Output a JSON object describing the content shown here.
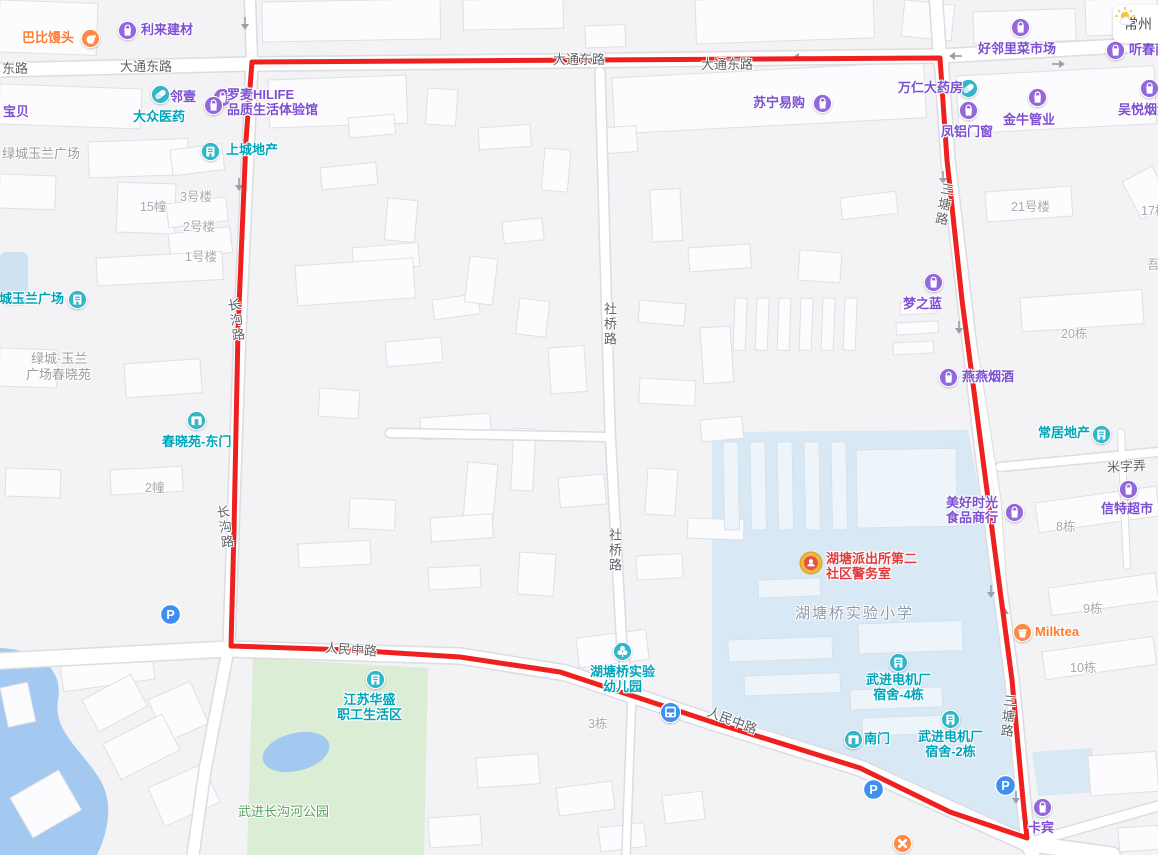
{
  "weather": {
    "city": "常州",
    "icon": "sun-cloud-icon"
  },
  "colors": {
    "purple": {
      "icon": "#9468dd",
      "text": "#7d4fd2"
    },
    "teal": {
      "icon": "#31b6ca",
      "text": "#00a4ba"
    },
    "orange": {
      "icon": "#ff8a45",
      "text": "#ff7a2e"
    },
    "red": {
      "icon": "#efb83d",
      "text": "#e03c3c"
    },
    "blue": {
      "icon": "#3d8ff2",
      "text": "#3d8ff2"
    },
    "boundary": "#ee2020",
    "water": "#a3c9f1",
    "park": "#dcedd6",
    "school_zone": "#d8e8f4"
  },
  "pois": [
    {
      "name": "babi-mantou",
      "text": "巴比馒头",
      "color": "orange",
      "icon": "hand",
      "ix": 90,
      "iy": 38,
      "tx": 22,
      "ty": 30
    },
    {
      "name": "lilai-jiancai",
      "text": "利来建材",
      "color": "purple",
      "icon": "bag",
      "ix": 127,
      "iy": 30,
      "tx": 141,
      "ty": 22
    },
    {
      "name": "haolinli-market",
      "text": "好邻里菜市场",
      "color": "purple",
      "icon": "bag",
      "ix": 1020,
      "iy": 27,
      "tx": 978,
      "ty": 41
    },
    {
      "name": "tingchun",
      "text": "听春南",
      "color": "purple",
      "icon": "bag",
      "ix": 1115,
      "iy": 50,
      "tx": 1129,
      "ty": 42
    },
    {
      "name": "linlinyi",
      "text": "邻邻壹",
      "color": "purple",
      "icon": "bag",
      "ix": 222,
      "iy": 97,
      "tx": 157,
      "ty": 89
    },
    {
      "name": "baobei",
      "text": "宝贝",
      "color": "purple",
      "tx": 3,
      "ty": 104
    },
    {
      "name": "dazhong-pharmacy",
      "text": "大众医药",
      "color": "teal",
      "icon": "pill",
      "ix": 160,
      "iy": 94,
      "tx": 133,
      "ty": 109
    },
    {
      "name": "luomai-hilife",
      "text": "罗麦HILIFE",
      "text2": "品质生活体验馆",
      "color": "purple",
      "icon": "bag",
      "ix": 213,
      "iy": 105,
      "tx": 227,
      "ty": 87
    },
    {
      "name": "shangcheng-estate",
      "text": "上城地产",
      "color": "teal",
      "icon": "estate",
      "ix": 210,
      "iy": 151,
      "tx": 226,
      "ty": 142
    },
    {
      "name": "suning",
      "text": "苏宁易购",
      "color": "purple",
      "icon": "bag",
      "ix": 822,
      "iy": 103,
      "tx": 753,
      "ty": 95
    },
    {
      "name": "wanren-pharmacy",
      "text": "万仁大药房",
      "color": "purple",
      "icon": "pill",
      "iconColor": "teal",
      "ix": 968,
      "iy": 88,
      "tx": 898,
      "ty": 80
    },
    {
      "name": "fenglv-doors",
      "text": "凤铝门窗",
      "color": "purple",
      "icon": "bag",
      "ix": 968,
      "iy": 110,
      "tx": 941,
      "ty": 124
    },
    {
      "name": "jinniu-pipes",
      "text": "金牛管业",
      "color": "purple",
      "icon": "bag",
      "ix": 1037,
      "iy": 97,
      "tx": 1003,
      "ty": 112
    },
    {
      "name": "wuyue-tobacco",
      "text": "吴悦烟酒",
      "color": "purple",
      "icon": "bag",
      "ix": 1149,
      "iy": 88,
      "tx": 1118,
      "ty": 102
    },
    {
      "name": "mengzhilan",
      "text": "梦之蓝",
      "color": "purple",
      "icon": "bag",
      "ix": 933,
      "iy": 282,
      "tx": 903,
      "ty": 296
    },
    {
      "name": "yanyan-tobacco",
      "text": "燕燕烟酒",
      "color": "purple",
      "icon": "bag",
      "ix": 948,
      "iy": 377,
      "tx": 962,
      "ty": 369
    },
    {
      "name": "changju-estate",
      "text": "常居地产",
      "color": "teal",
      "icon": "estate",
      "ix": 1101,
      "iy": 434,
      "tx": 1038,
      "ty": 425
    },
    {
      "name": "xinte-supermarket",
      "text": "信特超市",
      "color": "purple",
      "icon": "bag",
      "ix": 1128,
      "iy": 489,
      "tx": 1101,
      "ty": 501
    },
    {
      "name": "meihao-food",
      "text": "美好时光",
      "text2": "食品商行",
      "color": "purple",
      "icon": "bag",
      "ix": 1014,
      "iy": 512,
      "tx": 946,
      "ty": 495
    },
    {
      "name": "milktea",
      "text": "Milktea",
      "color": "orange",
      "icon": "cake",
      "ix": 1022,
      "iy": 632,
      "tx": 1035,
      "ty": 624
    },
    {
      "name": "kabin",
      "text": "卡宾",
      "color": "purple",
      "icon": "bag",
      "ix": 1042,
      "iy": 807,
      "tx": 1028,
      "ty": 820
    },
    {
      "name": "lvcheng-yulan-plaza-gate",
      "text": "绿城玉兰广场",
      "color": "teal",
      "icon": "estate",
      "ix": 77,
      "iy": 299,
      "tx": -14,
      "ty": 291
    },
    {
      "name": "chunxiaoyuan-east-gate",
      "text": "春晓苑-东门",
      "color": "teal",
      "icon": "gate",
      "ix": 196,
      "iy": 420,
      "tx": 162,
      "ty": 434
    },
    {
      "name": "police-room",
      "text": "湖塘派出所第二",
      "text2": "社区警务室",
      "color": "red",
      "icon": "police",
      "ix": 811,
      "iy": 563,
      "tx": 826,
      "ty": 551
    },
    {
      "name": "jiangsu-huasheng",
      "text": "江苏华盛",
      "text2": "职工生活区",
      "color": "teal",
      "icon": "estate",
      "ix": 375,
      "iy": 679,
      "tx": 337,
      "ty": 692,
      "ctr": true
    },
    {
      "name": "kindergarten",
      "text": "湖塘桥实验",
      "text2": "幼儿园",
      "color": "teal",
      "icon": "flower",
      "ix": 622,
      "iy": 651,
      "tx": 590,
      "ty": 664,
      "ctr": true
    },
    {
      "name": "dorm-4",
      "text": "武进电机厂",
      "text2": "宿舍-4栋",
      "color": "teal",
      "icon": "estate",
      "ix": 898,
      "iy": 662,
      "tx": 866,
      "ty": 672,
      "ctr": true
    },
    {
      "name": "south-gate",
      "text": "南门",
      "color": "teal",
      "icon": "gate",
      "ix": 853,
      "iy": 739,
      "tx": 864,
      "ty": 731
    },
    {
      "name": "dorm-2",
      "text": "武进电机厂",
      "text2": "宿舍-2栋",
      "color": "teal",
      "icon": "estate",
      "ix": 950,
      "iy": 719,
      "tx": 918,
      "ty": 729,
      "ctr": true
    },
    {
      "name": "parking-1",
      "color": "blue",
      "icon": "parking",
      "ix": 170,
      "iy": 614
    },
    {
      "name": "parking-2",
      "color": "blue",
      "icon": "parking",
      "ix": 873,
      "iy": 789
    },
    {
      "name": "parking-3",
      "color": "blue",
      "icon": "parking",
      "ix": 1005,
      "iy": 785
    },
    {
      "name": "bus-stop",
      "color": "blue",
      "icon": "bus",
      "ix": 670,
      "iy": 712
    },
    {
      "name": "road-closed",
      "color": "orange",
      "icon": "closed",
      "ix": 902,
      "iy": 843
    }
  ],
  "road_labels": [
    {
      "text": "东路",
      "x": 2,
      "y": 62
    },
    {
      "text": "大通东路",
      "x": 120,
      "y": 60
    },
    {
      "text": "大通东路",
      "x": 553,
      "y": 53
    },
    {
      "text": "大通东路",
      "x": 701,
      "y": 58
    },
    {
      "text": "人民中路",
      "x": 325,
      "y": 643,
      "rot": 4
    },
    {
      "text": "人民中路",
      "x": 706,
      "y": 714,
      "rot": 21
    },
    {
      "text": "社桥路",
      "x": 602,
      "y": 302,
      "vertical": true
    },
    {
      "text": "社桥路",
      "x": 607,
      "y": 528,
      "vertical": true
    },
    {
      "text": "长沟路",
      "x": 228,
      "y": 298,
      "vertical": true,
      "rot": -8
    },
    {
      "text": "长沟路",
      "x": 217,
      "y": 505,
      "vertical": true,
      "rot": -8
    },
    {
      "text": "三塘路",
      "x": 936,
      "y": 182,
      "vertical": true,
      "rot": 10
    },
    {
      "text": "三塘路",
      "x": 1000,
      "y": 694,
      "vertical": true,
      "rot": 5
    },
    {
      "text": "米字弄",
      "x": 1107,
      "y": 460,
      "rot": -3
    }
  ],
  "building_labels": [
    {
      "text": "15幢",
      "x": 140,
      "y": 196
    },
    {
      "text": "3号楼",
      "x": 180,
      "y": 186
    },
    {
      "text": "2号楼",
      "x": 183,
      "y": 216
    },
    {
      "text": "1号楼",
      "x": 185,
      "y": 246
    },
    {
      "text": "2幢",
      "x": 145,
      "y": 477
    },
    {
      "text": "21号楼",
      "x": 1011,
      "y": 196
    },
    {
      "text": "17栋",
      "x": 1141,
      "y": 200
    },
    {
      "text": "吾",
      "x": 1147,
      "y": 254
    },
    {
      "text": "20栋",
      "x": 1061,
      "y": 323
    },
    {
      "text": "8栋",
      "x": 1056,
      "y": 516
    },
    {
      "text": "9栋",
      "x": 1083,
      "y": 598
    },
    {
      "text": "10栋",
      "x": 1070,
      "y": 657
    },
    {
      "text": "3栋",
      "x": 588,
      "y": 713
    }
  ],
  "area_labels": [
    {
      "text": "绿城玉兰广场",
      "x": 2,
      "y": 146,
      "color": "gray"
    },
    {
      "text": "绿城·玉兰",
      "x": 31,
      "y": 351,
      "color": "gray"
    },
    {
      "text": "广场春晓苑",
      "x": 26,
      "y": 367,
      "color": "gray"
    },
    {
      "text": "湖塘桥实验小学",
      "x": 795,
      "y": 606,
      "color": "school",
      "size": 15,
      "ls": 2
    },
    {
      "text": "武进长沟河公园",
      "x": 238,
      "y": 804,
      "color": "green"
    }
  ]
}
